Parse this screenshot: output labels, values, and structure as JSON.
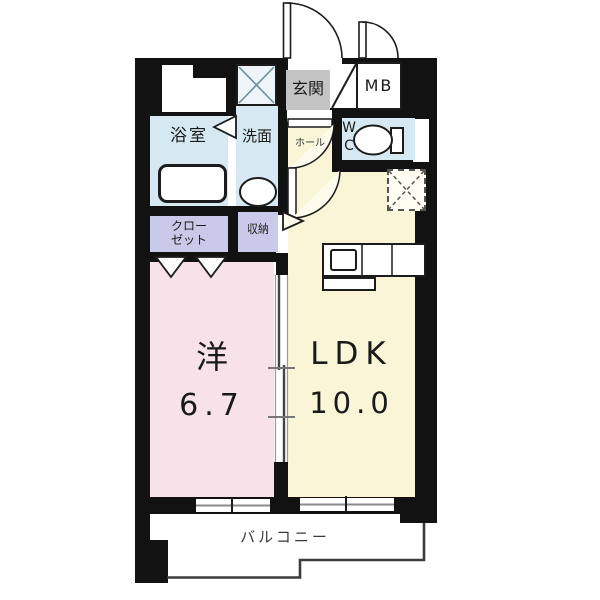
{
  "colors": {
    "wall": "#121212",
    "pink": "#f8e2ea",
    "cream": "#f9f5d6",
    "blue": "#d6e9f2",
    "lavender": "#c9c9ea",
    "gray": "#c4c4c4",
    "line": "#444444",
    "washer_x": "#6d8fa0"
  },
  "rooms": {
    "genkan": {
      "label": "玄関"
    },
    "mb": {
      "label": "MB"
    },
    "bathroom": {
      "label": "浴室"
    },
    "washroom": {
      "label": "洗面"
    },
    "hall": {
      "label": "ホール"
    },
    "wc": {
      "line1": "W",
      "line2": "C"
    },
    "closet": {
      "line1": "クロー",
      "line2": "ゼット"
    },
    "storage": {
      "label": "収納"
    },
    "western": {
      "label": "洋",
      "size": "6.7"
    },
    "ldk": {
      "label": "LDK",
      "size": "10.0"
    },
    "balcony": {
      "label": "バルコニー"
    }
  }
}
